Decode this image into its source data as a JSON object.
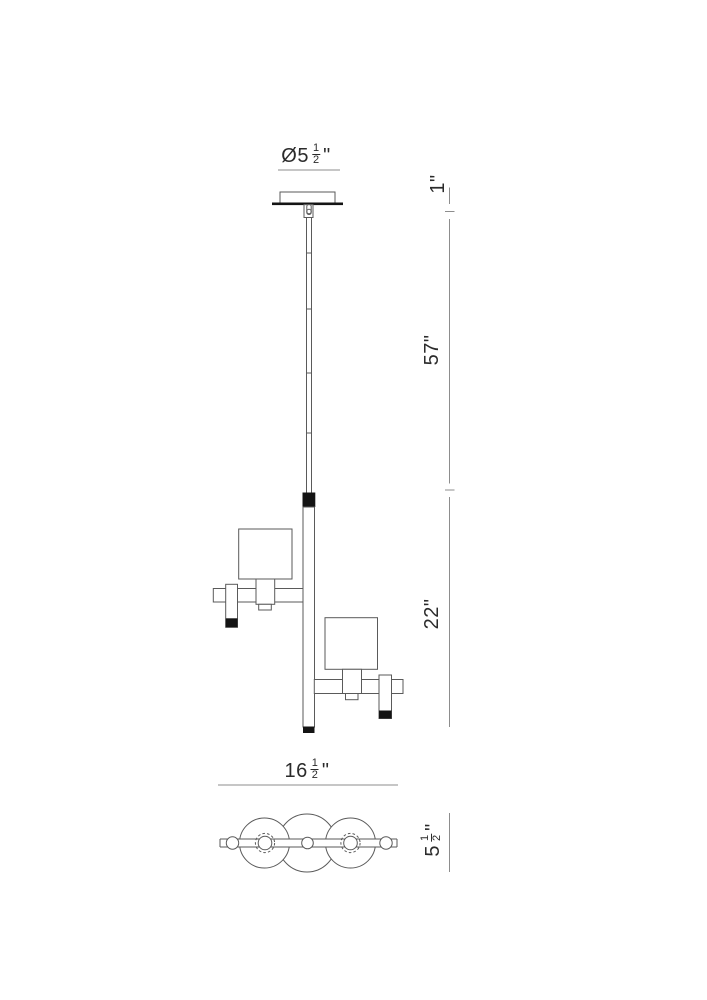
{
  "drawing": {
    "title": "Pendant light fixture dimensional drawing",
    "views": {
      "elevation": "front elevation with canopy, stem, two shades",
      "plan": "bottom plan view with three shade circles"
    },
    "labels": {
      "canopy_diameter": {
        "prefix": "Ø5",
        "num": "1",
        "den": "2",
        "suffix": "\""
      },
      "drop_top": "1\"",
      "drop_overall": "57\"",
      "body_height": "22\"",
      "fixture_width": {
        "prefix": "16",
        "num": "1",
        "den": "2",
        "suffix": "\""
      },
      "fixture_depth": {
        "prefix": "5",
        "num": "1",
        "den": "2",
        "suffix": "\""
      }
    },
    "colors": {
      "line_color": "#5a5a5a",
      "dim_color": "#8d8d8d",
      "fill_color": "#141414",
      "text_color": "#2b2b2b",
      "background": "#ffffff"
    }
  }
}
